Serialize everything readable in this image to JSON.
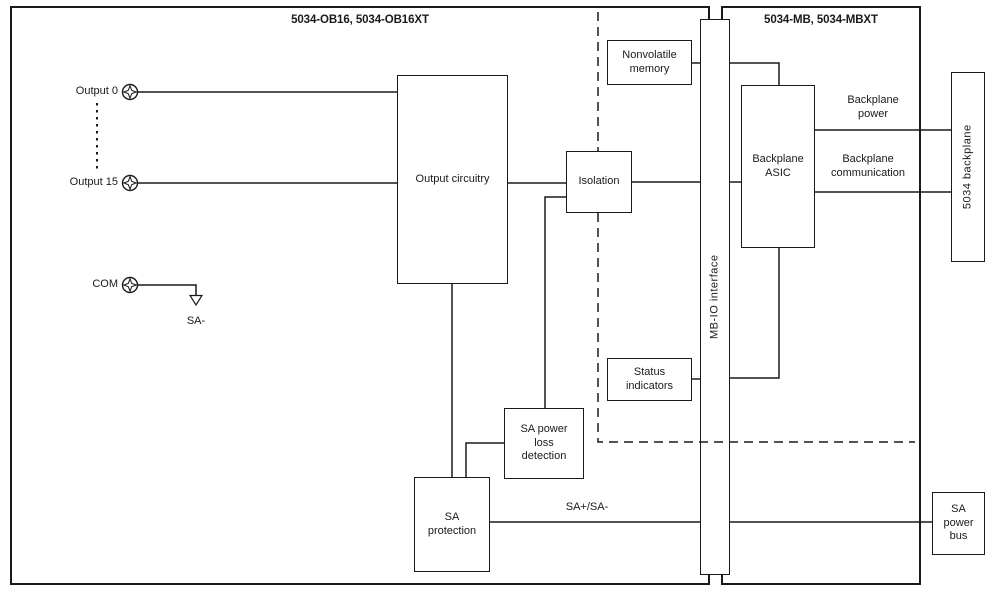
{
  "diagram": {
    "sections": {
      "left": {
        "title": "5034-OB16, 5034-OB16XT"
      },
      "right": {
        "title": "5034-MB, 5034-MBXT"
      }
    },
    "terminals": [
      {
        "label": "Output 0"
      },
      {
        "label": "Output 15"
      },
      {
        "label": "COM"
      }
    ],
    "ground_label": "SA-",
    "blocks": {
      "output_circuitry": "Output circuitry",
      "isolation": "Isolation",
      "nonvolatile_memory": "Nonvolatile\nmemory",
      "mbio_interface": "MB-IO interface",
      "backplane_asic": "Backplane\nASIC",
      "backplane_5034": "5034 backplane",
      "status_indicators": "Status\nindicators",
      "sa_power_loss_detection": "SA power\nloss\ndetection",
      "sa_protection": "SA\nprotection",
      "sa_power_bus": "SA\npower\nbus"
    },
    "wire_labels": {
      "backplane_power": "Backplane\npower",
      "backplane_communication": "Backplane\ncommunication",
      "sa_bus": "SA+/SA-"
    },
    "colors": {
      "line": "#1a1a1a",
      "background": "#ffffff"
    }
  }
}
